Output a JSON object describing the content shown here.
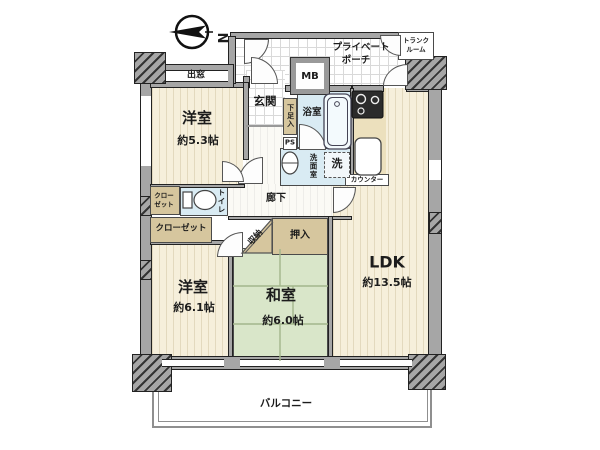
{
  "compass": {
    "north_label": "N"
  },
  "rooms": {
    "western1": {
      "name": "洋室",
      "size": "約5.3帖"
    },
    "western2": {
      "name": "洋室",
      "size": "約6.1帖"
    },
    "japanese": {
      "name": "和室",
      "size": "約6.0帖"
    },
    "ldk": {
      "name": "LDK",
      "size": "約13.5帖"
    }
  },
  "labels": {
    "demado": "出窓",
    "porch_line1": "プライベート",
    "porch_line2": "ポーチ",
    "trunk_line1": "トランク",
    "trunk_line2": "ルーム",
    "mb": "MB",
    "genkan": "玄関",
    "geta": "下足入",
    "ps": "PS",
    "bath": "浴室",
    "senmen": "洗面室",
    "laundry": "洗",
    "counter": "カウンター",
    "rouka": "廊下",
    "toilet": "トイレ",
    "closet_small_line1": "クロー",
    "closet_small_line2": "ゼット",
    "closet_long": "クローゼット",
    "shuno": "収納",
    "oshiire": "押入",
    "balcony": "バルコニー"
  },
  "colors": {
    "wall": "#a6a6a6",
    "flooring": "#f6efdb",
    "tatami": "#d9e6c9",
    "wet_area": "#d9ebf3",
    "closet": "#d6c69e",
    "line": "#222222"
  }
}
